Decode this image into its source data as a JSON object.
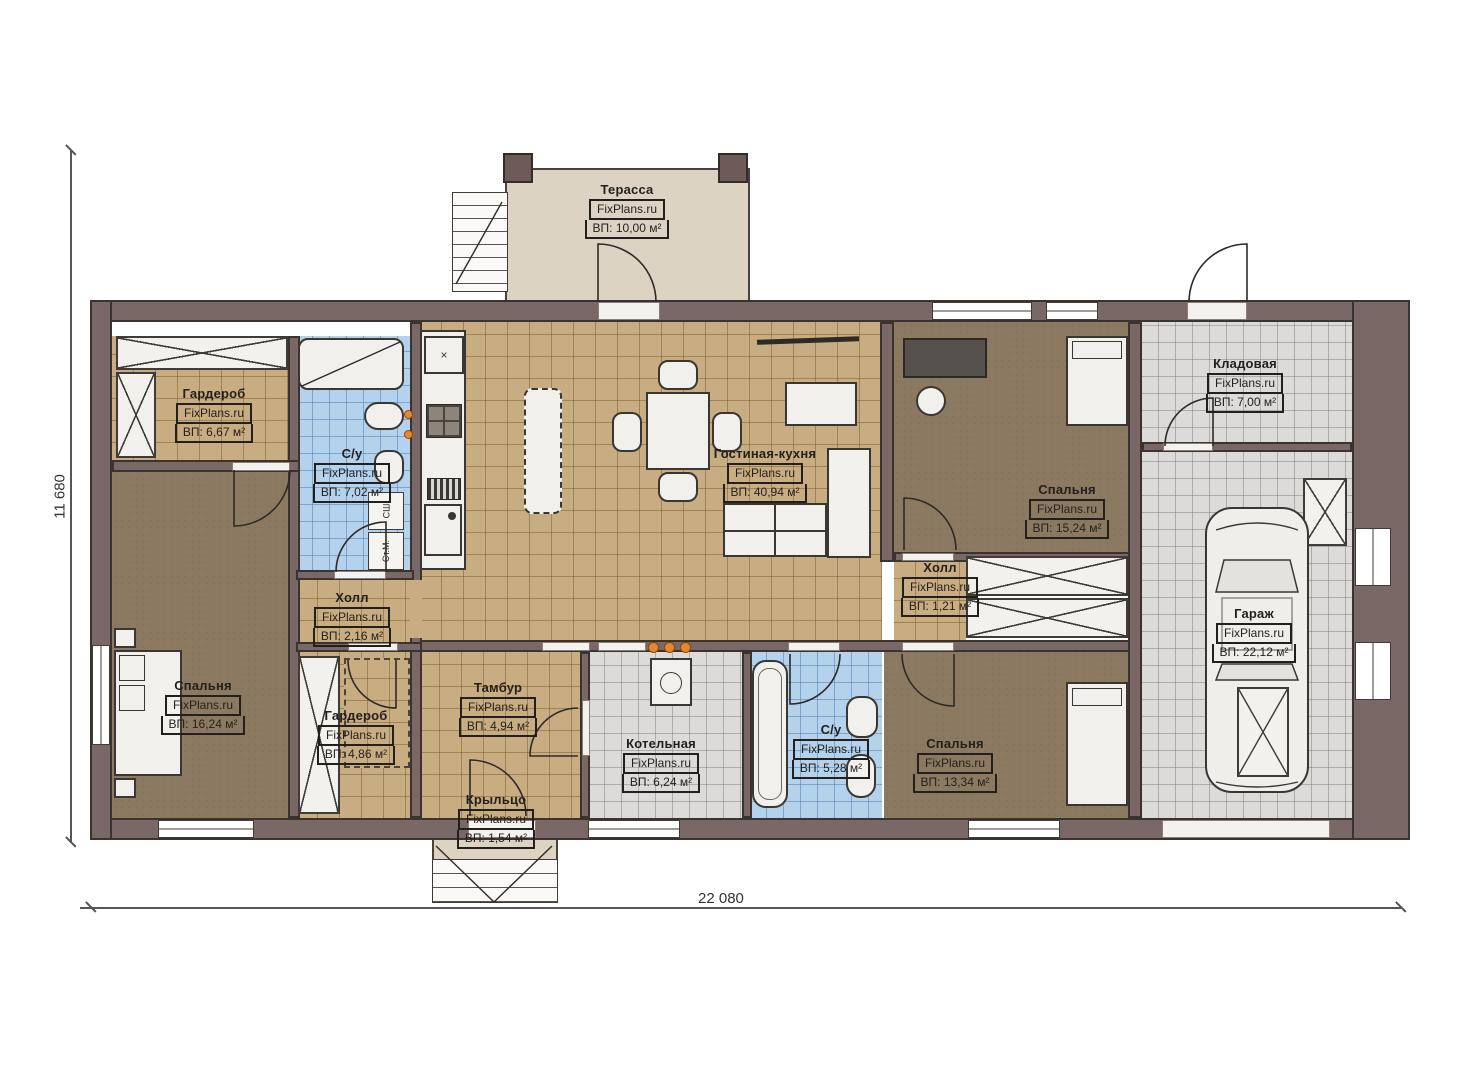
{
  "site": {
    "watermark": "FixPlans.ru"
  },
  "dimensions": {
    "height_label": "11 680",
    "width_label": "22 080"
  },
  "rooms": [
    {
      "name": "Терасса",
      "area": "ВП: 10,00 м²"
    },
    {
      "name": "Гардероб",
      "area": "ВП: 6,67 м²"
    },
    {
      "name": "С/у",
      "area": "ВП: 7,02 м²"
    },
    {
      "name": "Спальня",
      "area": "ВП: 16,24 м²"
    },
    {
      "name": "Холл",
      "area": "ВП: 2,16 м²"
    },
    {
      "name": "Гардероб",
      "area": "ВП: 4,86 м²"
    },
    {
      "name": "Тамбур",
      "area": "ВП: 4,94 м²"
    },
    {
      "name": "Крыльцо",
      "area": "ВП: 1,54 м²"
    },
    {
      "name": "Котельная",
      "area": "ВП: 6,24 м²"
    },
    {
      "name": "С/у",
      "area": "ВП: 5,28 м²"
    },
    {
      "name": "Спальня",
      "area": "ВП: 13,34 м²"
    },
    {
      "name": "Гостиная-кухня",
      "area": "ВП: 40,94 м²"
    },
    {
      "name": "Спальня",
      "area": "ВП: 15,24 м²"
    },
    {
      "name": "Холл",
      "area": "ВП: 1,21 м²"
    },
    {
      "name": "Кладовая",
      "area": "ВП: 7,00 м²"
    },
    {
      "name": "Гараж",
      "area": "ВП: 22,12 м²"
    }
  ],
  "appliances": {
    "dryer": "СШ",
    "washer": "Ст.М."
  },
  "colors": {
    "wall": "#796865",
    "tan_tile": "#c9ad82",
    "blue_tile": "#b4d2ec",
    "gray_tile": "#dcdbd9",
    "bedroom_floor": "#8b7a61",
    "terrace": "#ddd3c3",
    "fixture": "#f1f0ec",
    "accent_orange": "#e8872e",
    "ink": "#231f1c"
  }
}
